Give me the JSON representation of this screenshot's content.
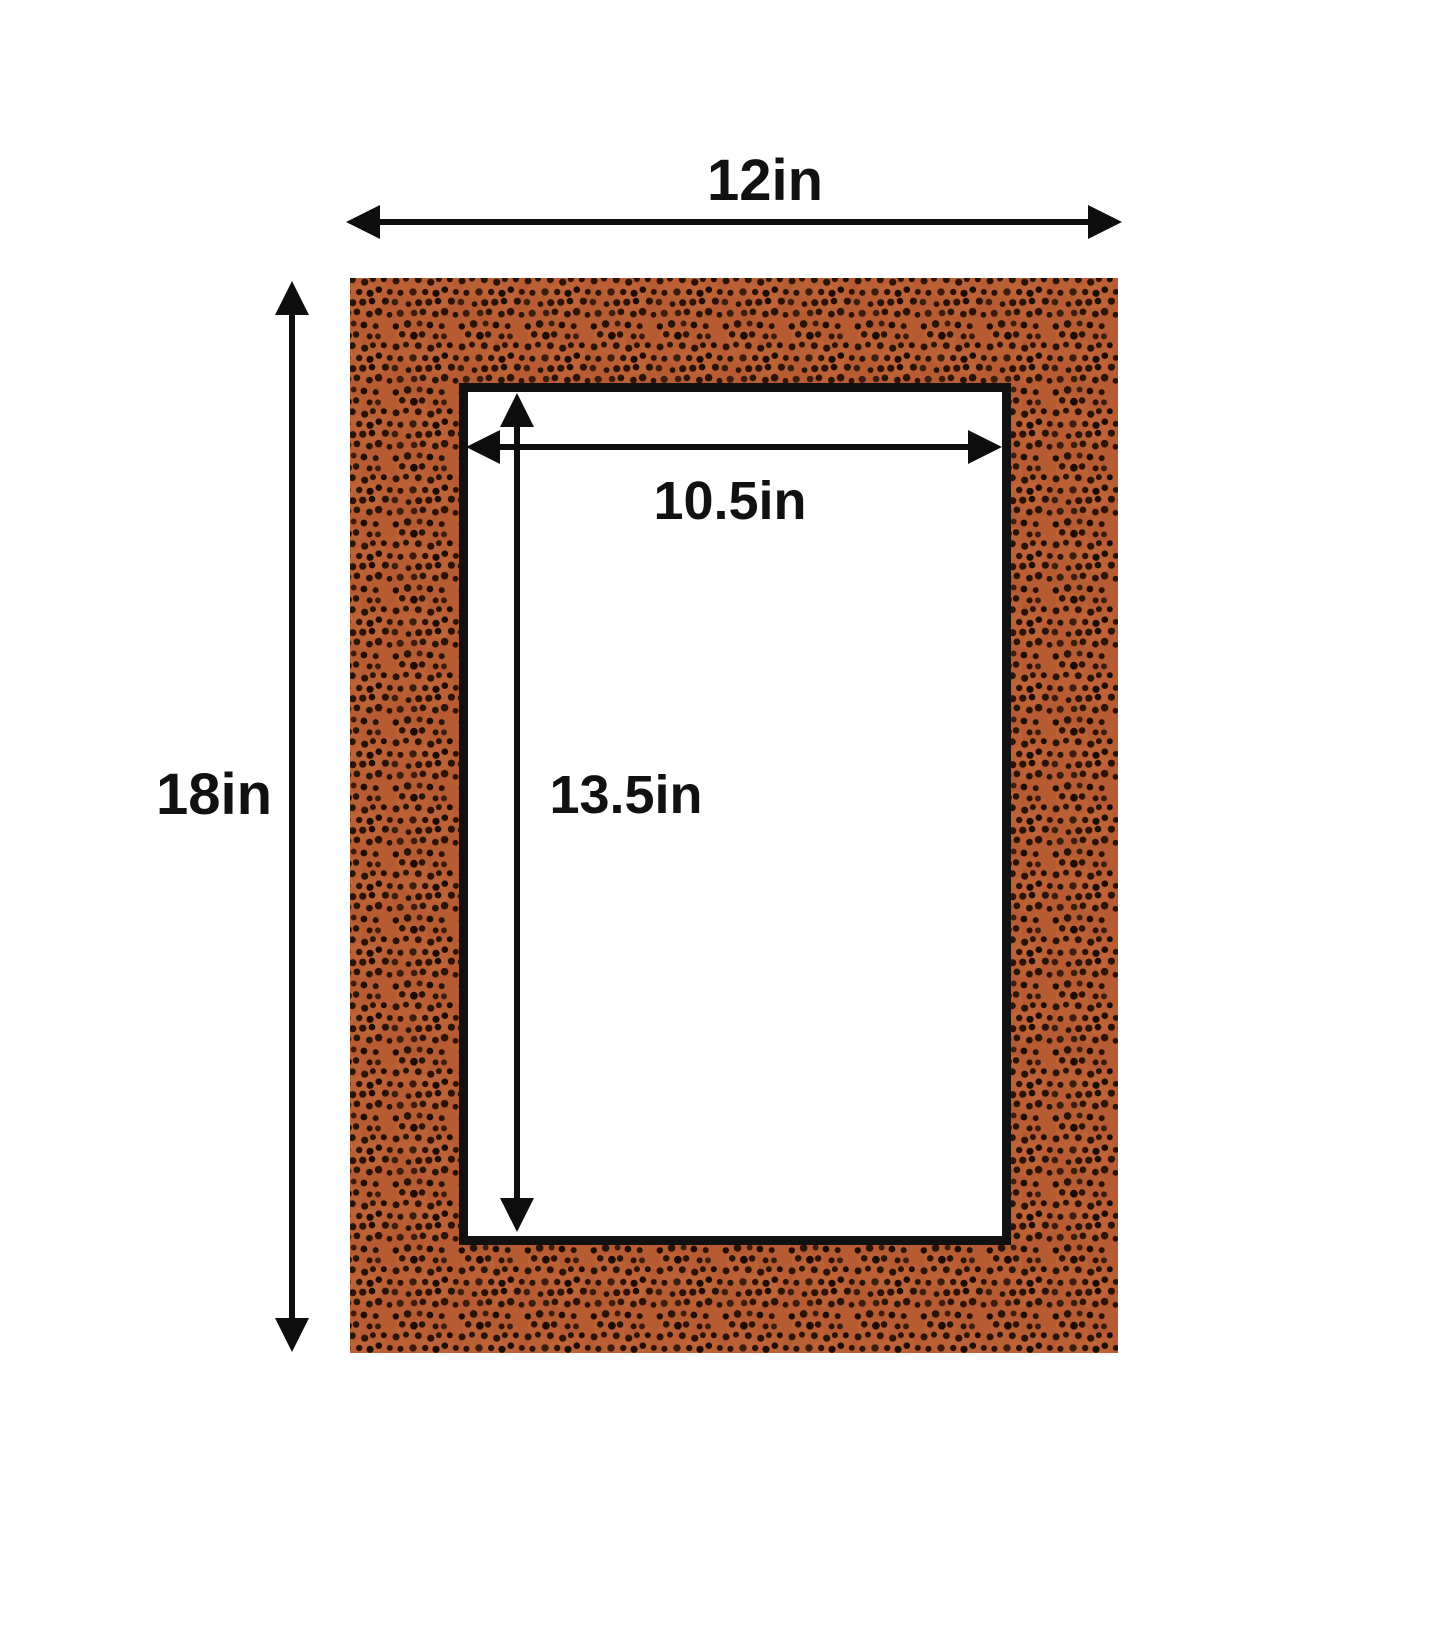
{
  "diagram": {
    "type": "picture-mat-dimension-diagram",
    "labels": {
      "outer_width": "12in",
      "outer_height": "18in",
      "opening_width": "10.5in",
      "opening_height": "13.5in"
    },
    "colors": {
      "background": "#ffffff",
      "mat_surface": "#b75b33",
      "mat_surface_light": "#c1663a",
      "pebble_dot": "#2a1309",
      "pebble_dot_dark": "#1c0c05",
      "pebble_dot_warm": "#3c1e10",
      "opening_fill": "#ffffff",
      "opening_border": "#111111",
      "arrow": "#0e0e0e",
      "label_text": "#111111"
    }
  }
}
